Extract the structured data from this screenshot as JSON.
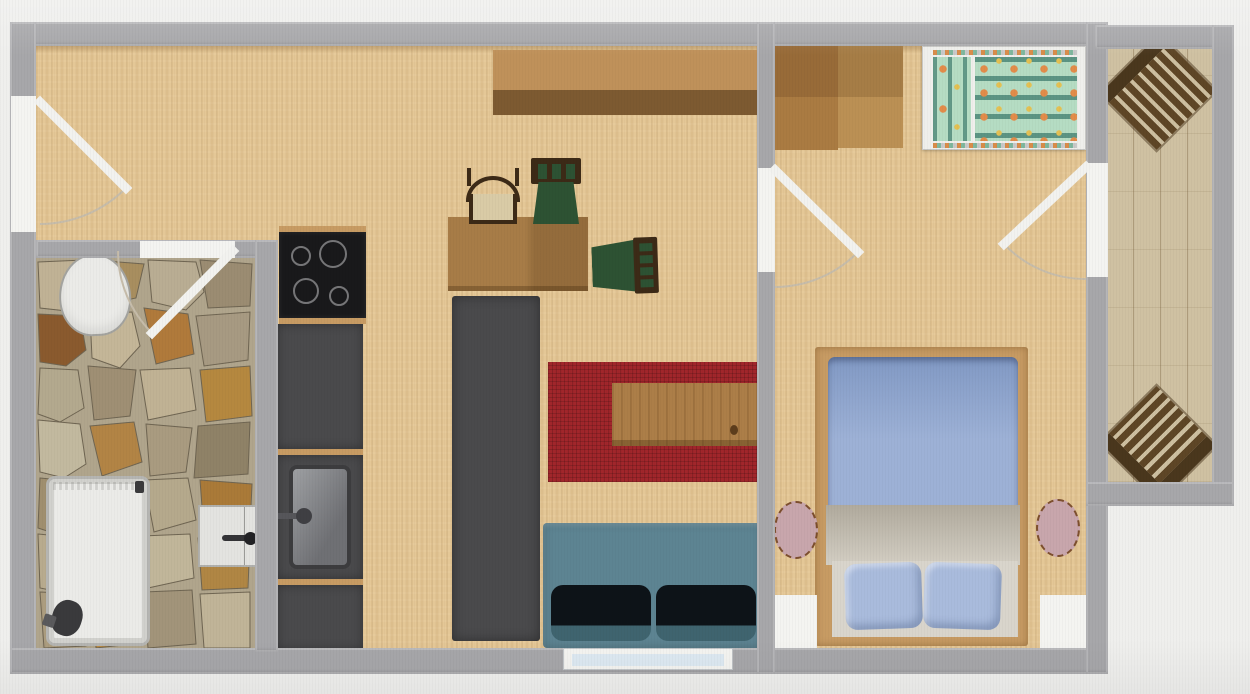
{
  "scene": {
    "type": "apartment-floor-plan",
    "rooms": [
      {
        "name": "hall-living-kitchen",
        "furniture": [
          "entrance-door",
          "sideboard",
          "cooktop",
          "kitchen-counter",
          "kitchen-sink",
          "dining-table",
          "chair-beige",
          "chair-green-top",
          "chair-green-side",
          "tall-cabinet",
          "red-rug",
          "coffee-table",
          "sofa",
          "window"
        ]
      },
      {
        "name": "bathroom",
        "furniture": [
          "toilet",
          "shower-tray",
          "valve",
          "washbasin",
          "stone-floor",
          "door"
        ]
      },
      {
        "name": "bedroom",
        "furniture": [
          "wardrobe",
          "crib",
          "double-bed",
          "duvet",
          "blanket",
          "pillows",
          "round-nightstand-left",
          "round-nightstand-right",
          "window-left",
          "window-right",
          "door-to-living",
          "door-to-balcony"
        ]
      },
      {
        "name": "balcony",
        "furniture": [
          "deck-chair-top",
          "deck-chair-bottom",
          "wood-decking"
        ]
      }
    ]
  },
  "palette": {
    "bg": "#efefed",
    "wall": "#a7a7aa",
    "white": "#f4f4f1",
    "floor": "#e4c796",
    "balcony-floor": "#cfc1a2",
    "stone-grout": "#b0a58c",
    "counter": "#4a4a4c",
    "hob": "#19191b",
    "hob-ring": "#8d8d90",
    "steel-dark": "#3c3c3e",
    "sideboard-top": "#bf915a",
    "sideboard-bottom": "#7d5a31",
    "table-wood": "#a77c47",
    "coffee-wood": "#ac7e48",
    "chair-wood": "#3c2a17",
    "chair-green": "#2d5233",
    "chair-beige": "#d9cba6",
    "rug": "#a1262b",
    "sofa": "#5d8492",
    "sofa-cushion": "#0d1318",
    "bed-frame": "#c79b63",
    "duvet": "#9db1d6",
    "duvet-deep": "#8199c4",
    "blanket": "#b0aa9d",
    "blanket-light": "#d3cec3",
    "pillow": "#a9bbdc",
    "bed-base": "#d9d5cc",
    "stool": "#c8a6ac",
    "fixture": "#ebebe8",
    "fixture-edge": "#b5b5b2",
    "valve": "#3a3a3c",
    "glass": "#dde9f2",
    "crib-frame": "#efefec",
    "crib-bg": "#b5dcc3",
    "crib-dot": "#e28c4a",
    "crib-dot2": "#e3c052",
    "wardrobe-a": "#aa7b42",
    "wardrobe-b": "#bb9054",
    "deck-slat": "#5e4626",
    "deck-gap": "#cdbfa0",
    "deck-bar": "#4a371d",
    "arc": "#c6bcaa"
  }
}
